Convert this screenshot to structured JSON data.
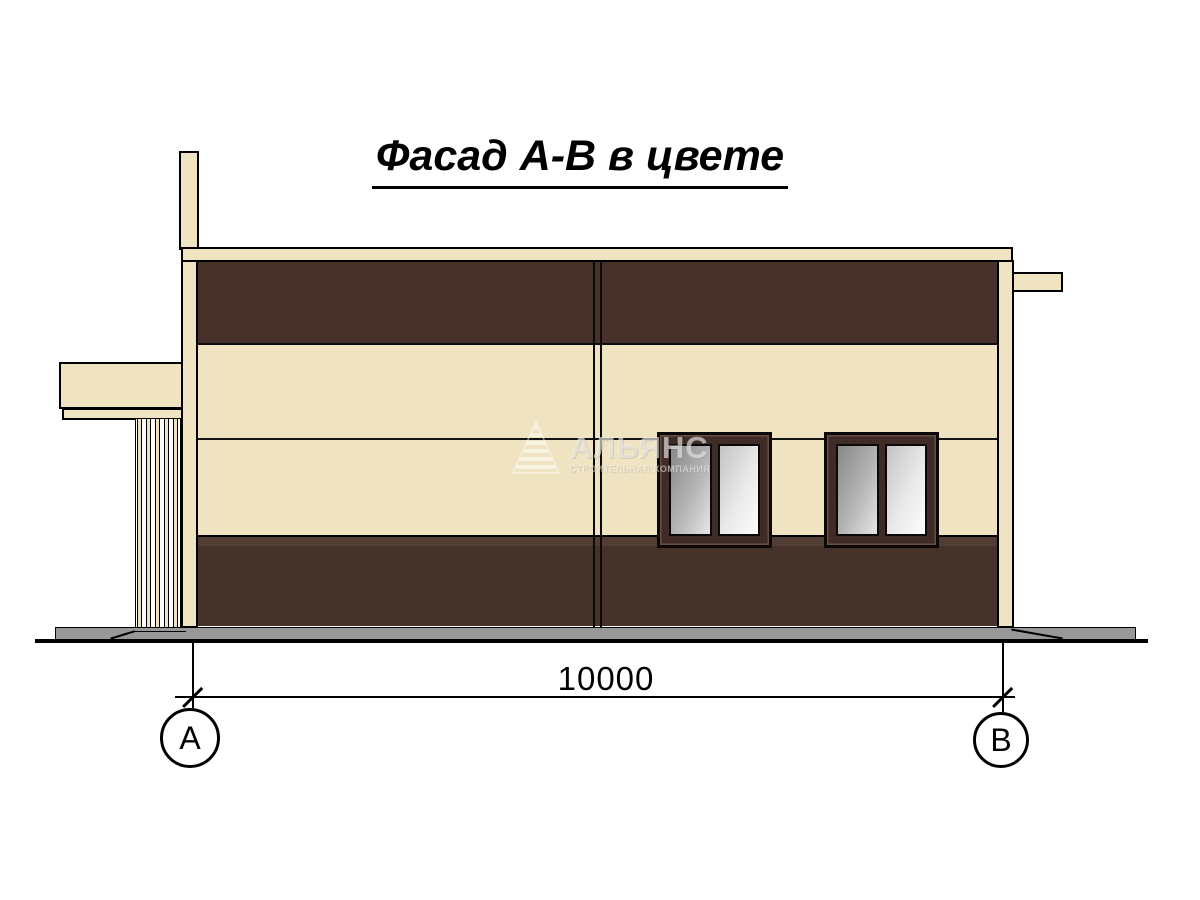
{
  "title": "Фасад А-В в цвете",
  "dimension_label": "10000",
  "axis_markers": {
    "left": "А",
    "right": "В"
  },
  "watermark": {
    "brand": "АЛЬЯНС",
    "tagline": "СТРОИТЕЛЬНАЯ КОМПАНИЯ",
    "logo": "striped-pyramid-icon"
  },
  "colors": {
    "paper": "#FFFFFF",
    "cream": "#F0E3C1",
    "brown_top": "#45312A",
    "plinth": "#44322B",
    "plinth_light": "#523D34",
    "window_frame": "#3F2C27",
    "ground_gray": "#989898",
    "ink": "#000000"
  }
}
